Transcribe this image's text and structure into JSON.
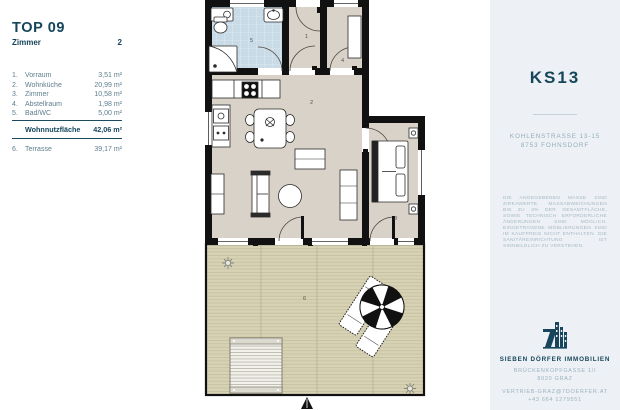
{
  "left_panel": {
    "title": "TOP 09",
    "rooms_label": "Zimmer",
    "rooms_count": "2",
    "items": [
      {
        "num": "1.",
        "name": "Vorraum",
        "area": "3,51 m²"
      },
      {
        "num": "2.",
        "name": "Wohnküche",
        "area": "20,99 m²"
      },
      {
        "num": "3.",
        "name": "Zimmer",
        "area": "10,58 m²"
      },
      {
        "num": "4.",
        "name": "Abstellraum",
        "area": "1,98 m²"
      },
      {
        "num": "5.",
        "name": "Bad/WC",
        "area": "5,00 m²"
      }
    ],
    "total_label": "Wohnnutzfläche",
    "total_area": "42,06 m²",
    "outdoor": {
      "num": "6.",
      "name": "Terrasse",
      "area": "39,17 m²"
    }
  },
  "plan": {
    "rooms": [
      {
        "number": "1",
        "name": "Vorraum"
      },
      {
        "number": "2",
        "name": "Wohnküche"
      },
      {
        "number": "3",
        "name": "Zimmer"
      },
      {
        "number": "4",
        "name": "Abstellraum"
      },
      {
        "number": "5",
        "name": "Bad/WC"
      },
      {
        "number": "6",
        "name": "Terrasse"
      }
    ]
  },
  "right_panel": {
    "title": "KS13",
    "address_line1": "KOHLENSTRASSE 13-15",
    "address_line2": "8753 FOHNSDORF",
    "disclaimer": "DIE ANGEGEBENEN MASSE SIND ZIRKAWERTE. MASSABWEICHUNGEN BIS ZU 3% DER GESAMTFLÄCHE, SOWIE TECHNISCH ERFORDERLICHE ÄNDERUNGEN SIND MÖGLICH. EINGETRAGENE MÖBLIERUNGEN SIND IM KAUFPREIS NICHT ENTHALTEN. DIE SANITÄREINRICHTUNG IST SINNBILDLICH ZU VERSTEHEN.",
    "company": "SIEBEN DÖRFER IMMOBILIEN",
    "company_address1": "BRÜCKENKOPFGASSE 1/I",
    "company_address2": "8020 GRAZ",
    "contact_email": "VERTRIEB-GRAZ@7DOERFER.AT",
    "contact_phone": "+43 664 1279551"
  },
  "colors": {
    "brand_navy": "#17465c",
    "muted_blue": "#93acba",
    "panel_bg": "#edf1f5",
    "floor": "#d9d2c8",
    "bath_blue": "#c9dbe7",
    "terrace": "#d8d2b5",
    "wall": "#111111"
  }
}
